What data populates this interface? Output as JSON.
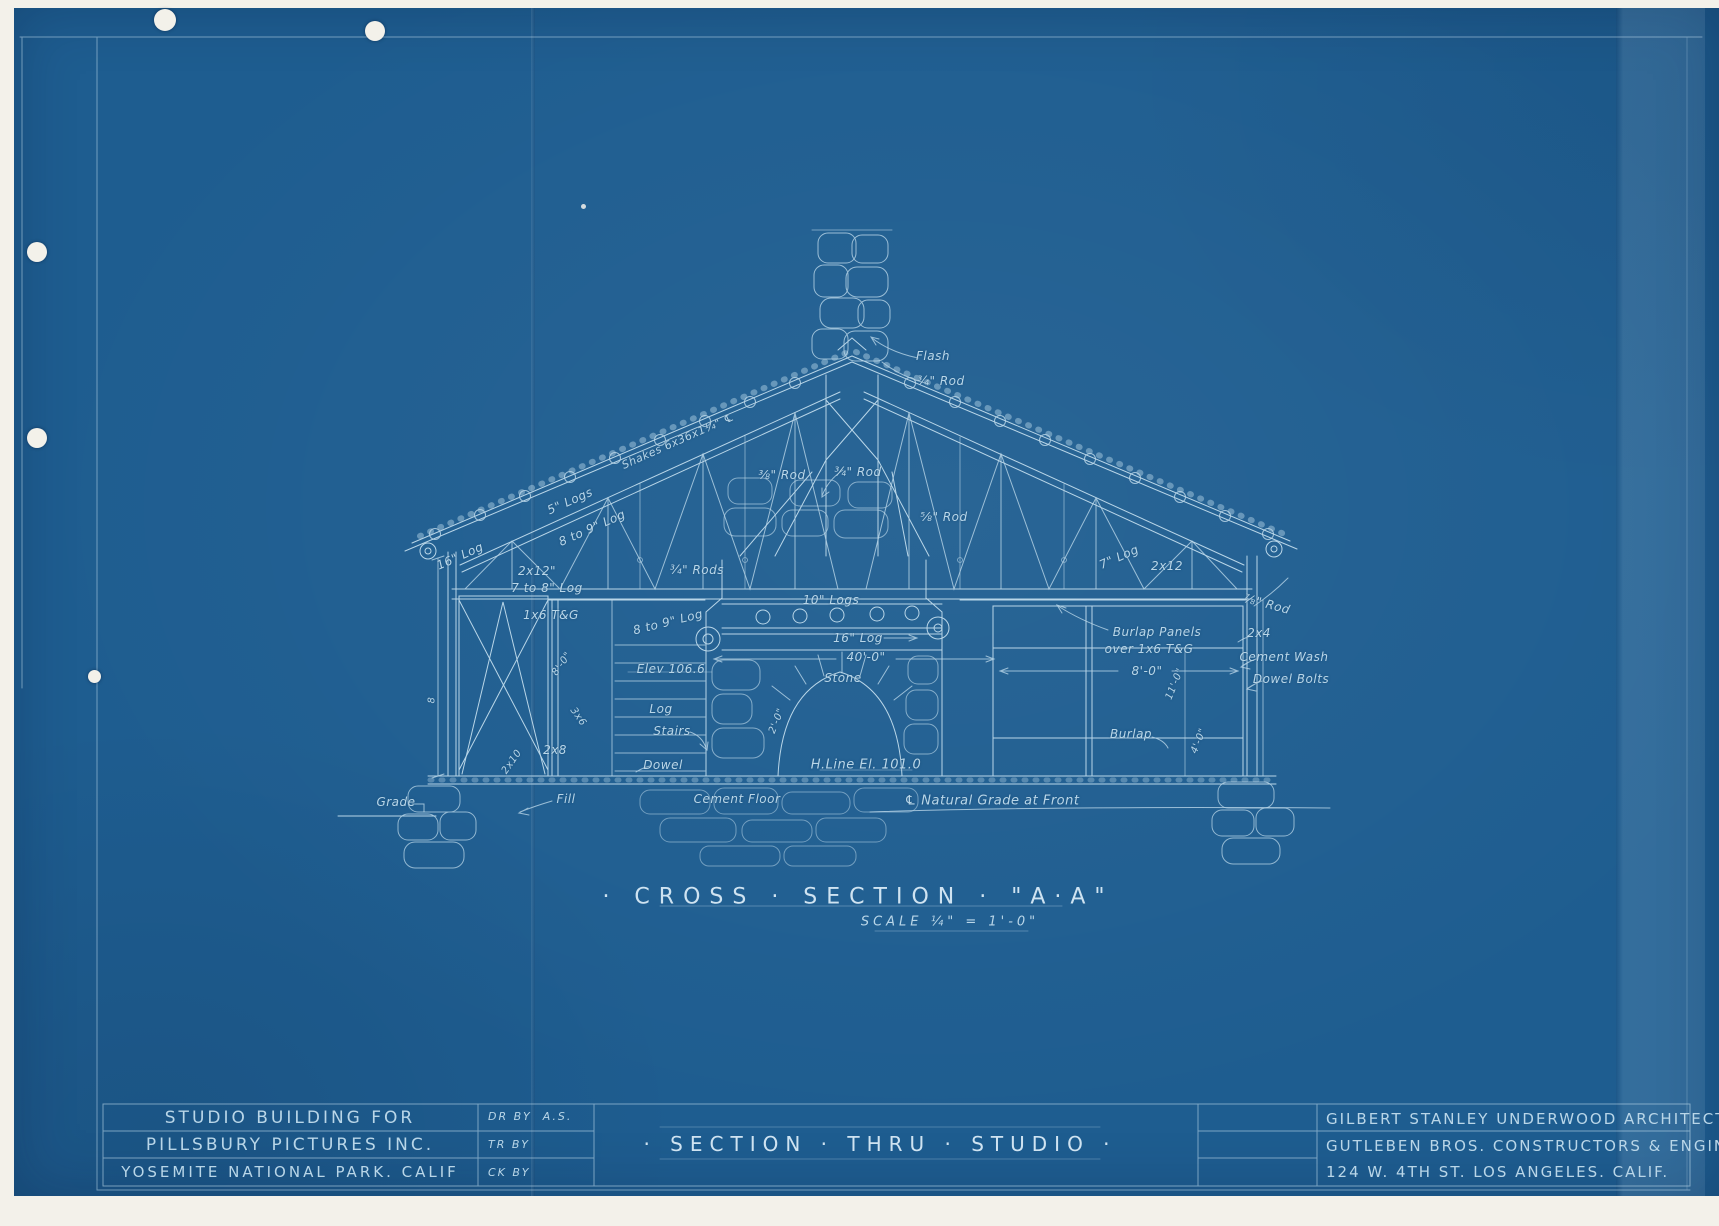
{
  "colors": {
    "paper": "#f3f1ea",
    "sheet": "#1e5d90",
    "ink": "#b9d6e8",
    "ink-bright": "#cfe3f1",
    "ink-dim": "#8fb8d4"
  },
  "sheet": {
    "drawing_title": "· CROSS · SECTION · \"A·A\"",
    "drawing_scale": "SCALE ¼\" = 1'-0\""
  },
  "title_block": {
    "project_line1": "STUDIO BUILDING FOR",
    "project_line2": "PILLSBURY PICTURES INC.",
    "project_line3": "YOSEMITE NATIONAL PARK. CALIF",
    "dr_by_label": "DR BY",
    "dr_by_value": "A.S.",
    "tr_by_label": "TR BY",
    "ck_by_label": "CK BY",
    "sheet_title": "· SECTION · THRU · STUDIO ·",
    "firm_line1": "GILBERT STANLEY UNDERWOOD ARCHITECT",
    "firm_line2": "GUTLEBEN BROS. CONSTRUCTORS & ENGINEERS",
    "firm_line3": "124 W. 4TH ST. LOS ANGELES. CALIF."
  },
  "annotations": [
    {
      "text": "16\" Log",
      "x": 460,
      "y": 556,
      "rot": -24
    },
    {
      "text": "5\" Logs",
      "x": 570,
      "y": 501,
      "rot": -24
    },
    {
      "text": "Shakes 6x36x1¼\" ℄",
      "x": 678,
      "y": 441,
      "rot": -24,
      "size": 11
    },
    {
      "text": "8 to 9\" Log",
      "x": 592,
      "y": 528,
      "rot": -24
    },
    {
      "text": "2x12\"",
      "x": 537,
      "y": 571
    },
    {
      "text": "7 to 8\" Log",
      "x": 547,
      "y": 588
    },
    {
      "text": "1x6 T&G",
      "x": 551,
      "y": 615
    },
    {
      "text": "¾\" Rods",
      "x": 697,
      "y": 570
    },
    {
      "text": "8 to 9\" Log",
      "x": 668,
      "y": 622,
      "rot": -14
    },
    {
      "text": "Elev 106.6",
      "x": 671,
      "y": 669
    },
    {
      "text": "Log",
      "x": 661,
      "y": 709
    },
    {
      "text": "Stairs",
      "x": 672,
      "y": 731
    },
    {
      "text": "Dowel",
      "x": 663,
      "y": 765
    },
    {
      "text": "2x8",
      "x": 555,
      "y": 750
    },
    {
      "text": "3x6",
      "x": 578,
      "y": 717,
      "rot": 55,
      "size": 10
    },
    {
      "text": "2x10",
      "x": 512,
      "y": 762,
      "rot": -55,
      "size": 10
    },
    {
      "text": "8'-0\"",
      "x": 562,
      "y": 664,
      "rot": -55,
      "size": 10
    },
    {
      "text": "8",
      "x": 432,
      "y": 700,
      "rot": -90,
      "size": 10
    },
    {
      "text": "Grade",
      "x": 396,
      "y": 802
    },
    {
      "text": "Fill",
      "x": 566,
      "y": 799
    },
    {
      "text": "Cement Floor",
      "x": 737,
      "y": 799
    },
    {
      "text": "℄ Natural Grade at Front",
      "x": 992,
      "y": 801,
      "size": 13
    },
    {
      "text": "Flash",
      "x": 933,
      "y": 356
    },
    {
      "text": "¾\" Rod",
      "x": 941,
      "y": 381
    },
    {
      "text": "¾\" Rod",
      "x": 858,
      "y": 472
    },
    {
      "text": "⅜\" Rod",
      "x": 782,
      "y": 475
    },
    {
      "text": "⅝\" Rod",
      "x": 944,
      "y": 517
    },
    {
      "text": "10\" Logs",
      "x": 831,
      "y": 600
    },
    {
      "text": "16\" Log",
      "x": 858,
      "y": 638
    },
    {
      "text": "40'-0\"",
      "x": 866,
      "y": 657
    },
    {
      "text": "Stone",
      "x": 843,
      "y": 678
    },
    {
      "text": "H.Line El. 101.0",
      "x": 866,
      "y": 765,
      "size": 13
    },
    {
      "text": "2'-0\"",
      "x": 777,
      "y": 721,
      "rot": -68,
      "size": 10
    },
    {
      "text": "7\" Log",
      "x": 1119,
      "y": 557,
      "rot": -24
    },
    {
      "text": "2x12",
      "x": 1167,
      "y": 566
    },
    {
      "text": "⅞\" Rod",
      "x": 1267,
      "y": 604,
      "rot": 15
    },
    {
      "text": "Burlap Panels",
      "x": 1157,
      "y": 632
    },
    {
      "text": "over 1x6 T&G",
      "x": 1149,
      "y": 649
    },
    {
      "text": "8'-0\"",
      "x": 1147,
      "y": 671
    },
    {
      "text": "11'-0\"",
      "x": 1175,
      "y": 684,
      "rot": -68,
      "size": 10
    },
    {
      "text": "Burlap",
      "x": 1131,
      "y": 734
    },
    {
      "text": "2x4",
      "x": 1259,
      "y": 633
    },
    {
      "text": "Cement Wash",
      "x": 1284,
      "y": 657
    },
    {
      "text": "Dowel Bolts",
      "x": 1291,
      "y": 679
    },
    {
      "text": "4'-0\"",
      "x": 1199,
      "y": 741,
      "rot": -68,
      "size": 10
    }
  ]
}
